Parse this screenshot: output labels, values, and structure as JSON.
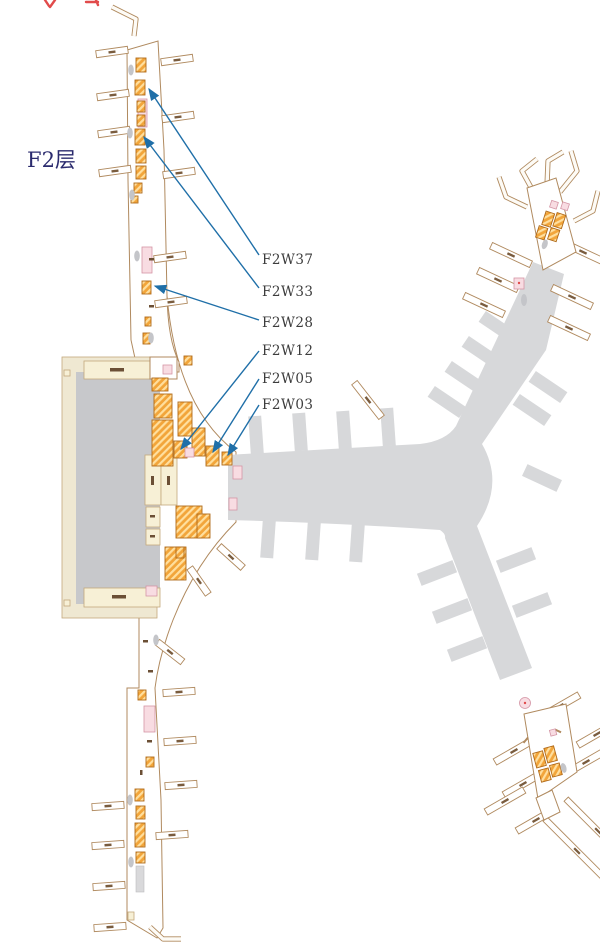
{
  "floor": {
    "label": "F2层"
  },
  "locations": {
    "labels": [
      {
        "code": "F2W37"
      },
      {
        "code": "F2W33"
      },
      {
        "code": "F2W28"
      },
      {
        "code": "F2W12"
      },
      {
        "code": "F2W05"
      },
      {
        "code": "F2W03"
      }
    ]
  },
  "colors": {
    "leader_line": "#1f6fa8",
    "floor_label_text": "#2b2b6e",
    "location_label_text": "#3c3c3c",
    "shop_fill": "#f2a53a",
    "shop_border": "#b06a1a",
    "apron_gray": "#d7d8da",
    "building_gray": "#c7c8cb",
    "outline_tan": "#b08a5f",
    "cream": "#f7f0d6",
    "beige": "#efe8d2",
    "pink": "#f8dce2",
    "cropped_annotation_red": "#e14b4b"
  }
}
